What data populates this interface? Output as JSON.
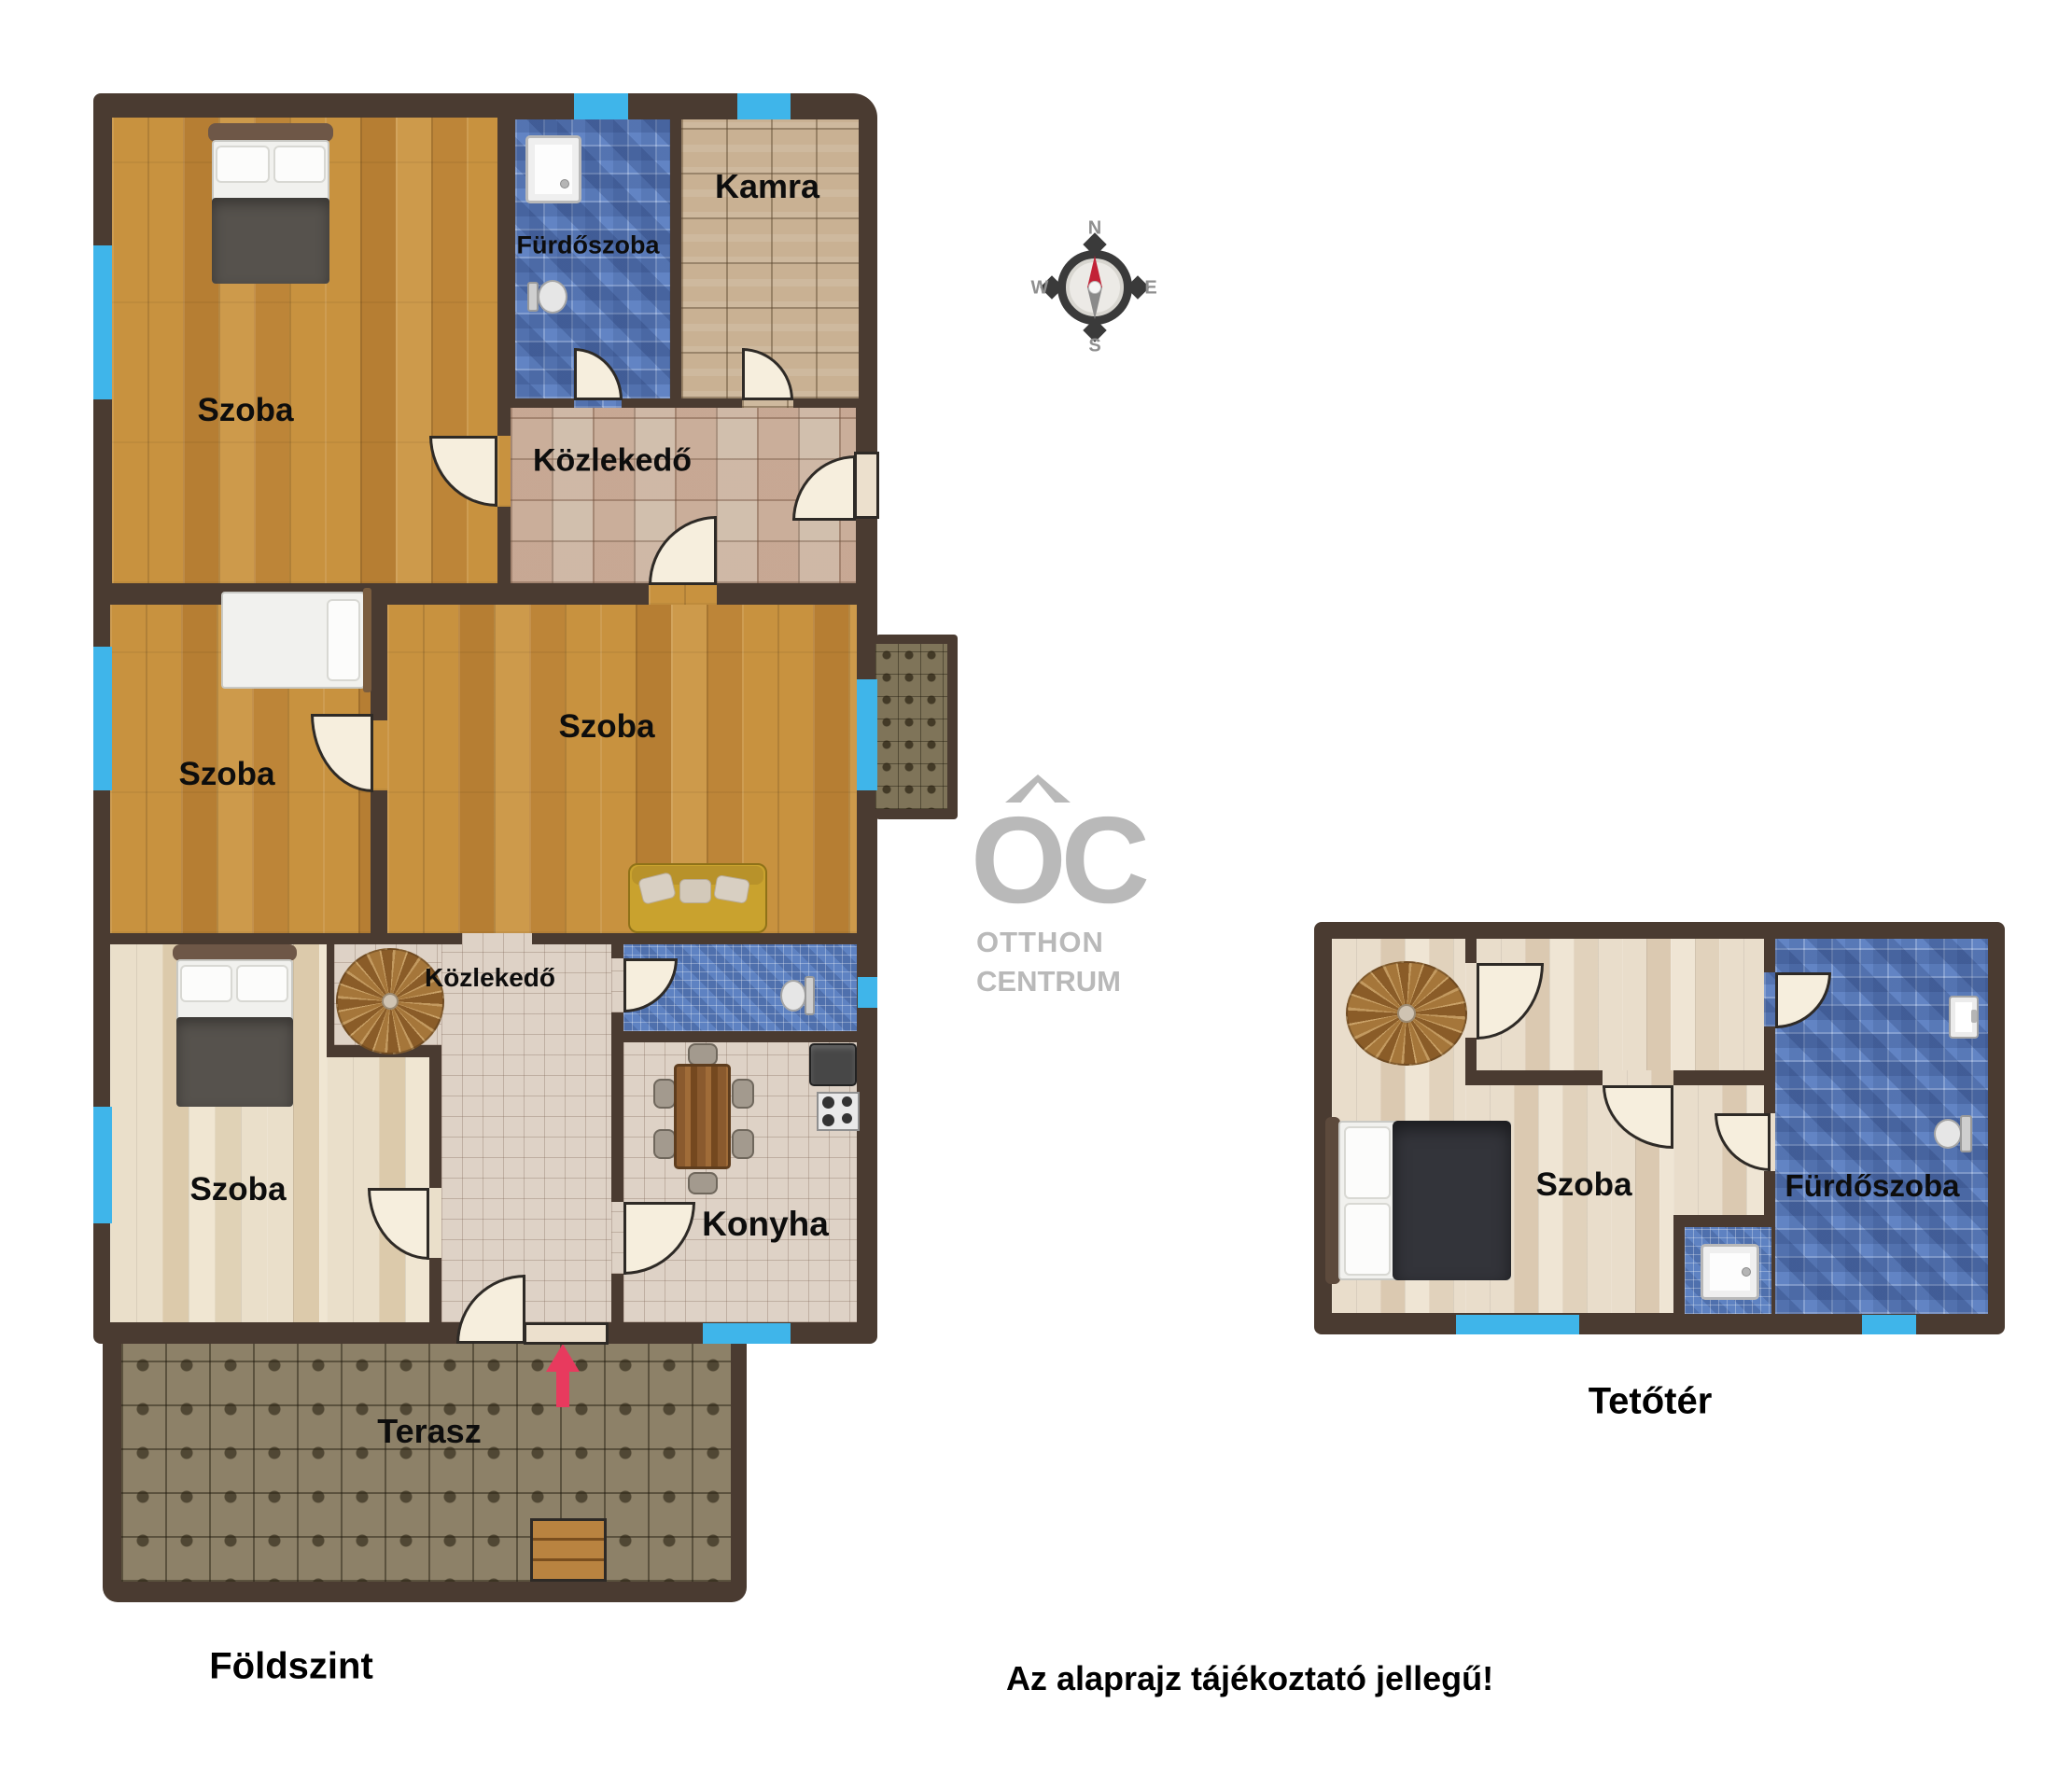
{
  "titles": {
    "ground_floor": "Földszint",
    "attic": "Tetőtér",
    "disclaimer": "Az alaprajz tájékoztató jellegű!"
  },
  "brand": {
    "monogram": "OC",
    "line1": "OTTHON",
    "line2": "CENTRUM"
  },
  "compass": {
    "north": "N",
    "east": "E",
    "south": "S",
    "west": "W"
  },
  "ground_floor_rooms": {
    "bedroom_nw": {
      "label": "Szoba"
    },
    "bathroom": {
      "label": "Fürdőszoba"
    },
    "pantry": {
      "label": "Kamra"
    },
    "hallway_upper": {
      "label": "Közlekedő"
    },
    "bedroom_w": {
      "label": "Szoba"
    },
    "bedroom_center": {
      "label": "Szoba"
    },
    "bedroom_sw": {
      "label": "Szoba"
    },
    "hallway_lower": {
      "label": "Közlekedő"
    },
    "kitchen": {
      "label": "Konyha"
    },
    "terrace": {
      "label": "Terasz"
    }
  },
  "attic_rooms": {
    "bedroom": {
      "label": "Szoba"
    },
    "bathroom": {
      "label": "Fürdőszoba"
    }
  },
  "colors": {
    "wall": "#4a3b31",
    "window": "#3fb5ea",
    "entry_arrow": "#e83a5e",
    "brand_gray": "#b9b9b9"
  }
}
